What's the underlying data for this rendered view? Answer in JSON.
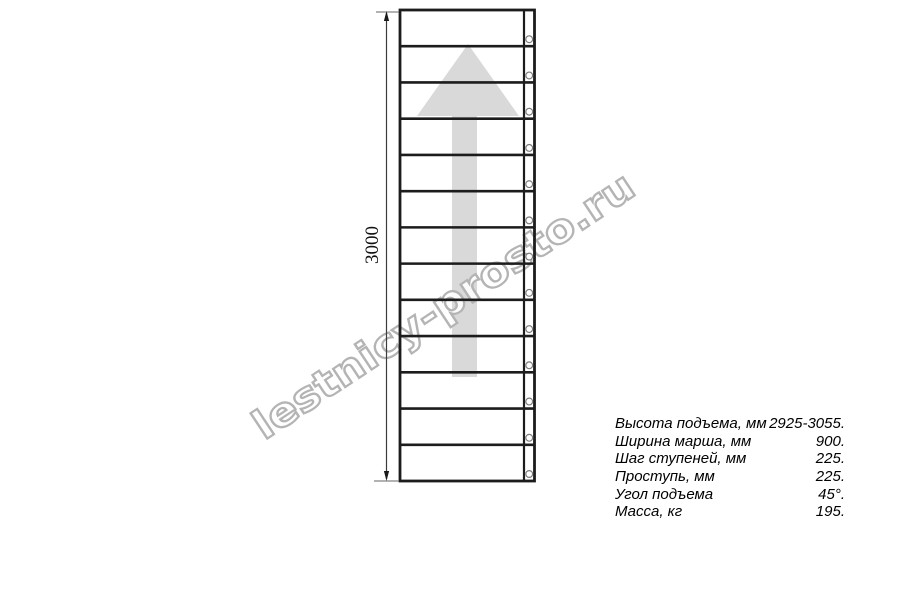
{
  "watermark": {
    "text": "lestnicy-prosto.ru",
    "outline_color": "#b4b4b4"
  },
  "drawing": {
    "dimension_label": "3000",
    "steps_count": 13,
    "colors": {
      "line": "#1c1c1c",
      "arrow_fill": "#d9d9d9",
      "dimension_line": "#3c3c3c",
      "circle_stroke": "#7d7d7d"
    }
  },
  "specs": {
    "rows": [
      {
        "label": "Высота подъема, мм",
        "value": "2925-3055."
      },
      {
        "label": "Ширина марша, мм",
        "value": "900."
      },
      {
        "label": "Шаг ступеней, мм",
        "value": "225."
      },
      {
        "label": "Проступь, мм",
        "value": "225."
      },
      {
        "label": "Угол подъема",
        "value": "45°."
      },
      {
        "label": "Масса, кг",
        "value": "195."
      }
    ]
  }
}
